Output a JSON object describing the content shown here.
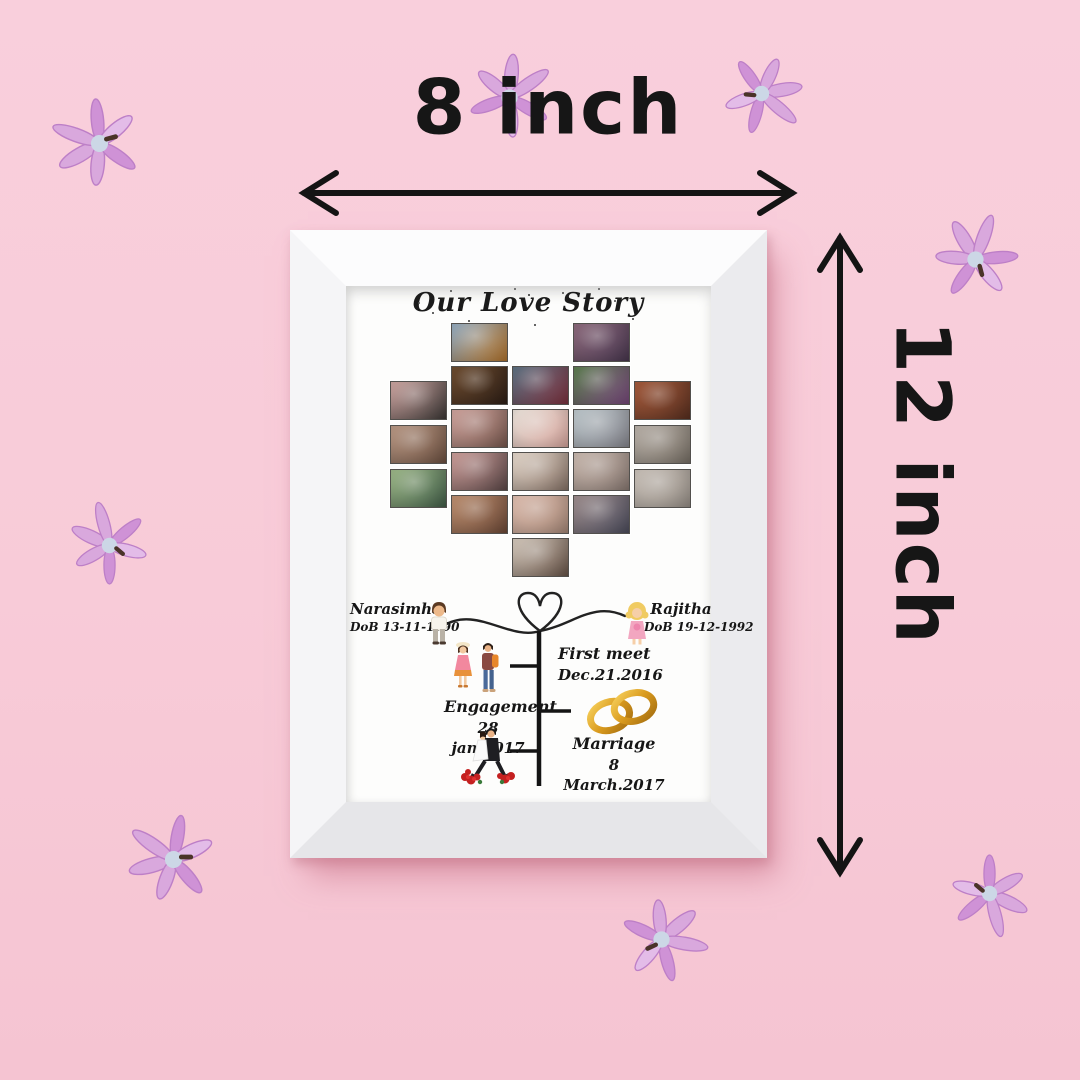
{
  "scene": {
    "description": "Personalized love story photo frame product shot on pink background with lilac hyacinth flowers",
    "background_color": "#f8cbd8",
    "frame_color": "#f5f5f7",
    "annotation_color": "#161616"
  },
  "dimensions": {
    "width_label": "8 inch",
    "height_label": "12 inch"
  },
  "frame": {
    "title": "Our Love Story",
    "timeline": {
      "groom": {
        "name": "Narasimha",
        "dob": "DoB 13-11-1990"
      },
      "bride": {
        "name": "Rajitha",
        "dob": "DoB 19-12-1992"
      },
      "events": [
        {
          "label": "First meet",
          "date": "Dec.21.2016"
        },
        {
          "label": "Engagement",
          "date": "28 jan.2017"
        },
        {
          "label": "Marriage",
          "date": "8 March.2017"
        }
      ],
      "illustrations": {
        "heart": "heart-doodle",
        "groom_avatar": "cartoon-man",
        "bride_avatar": "cartoon-woman",
        "dating_couple": "cartoon-dating-couple",
        "rings": "gold-wedding-rings",
        "wedding_couple": "cartoon-wedding-couple"
      }
    },
    "collage_photos": [
      {
        "col": 0,
        "y": 58,
        "c1": "#c9a29e",
        "c2": "#3f3a38"
      },
      {
        "col": 0,
        "y": 102,
        "c1": "#b59582",
        "c2": "#6e5242"
      },
      {
        "col": 0,
        "y": 146,
        "c1": "#9ab486",
        "c2": "#44604a"
      },
      {
        "col": 1,
        "y": 0,
        "c1": "#8fa7bc",
        "c2": "#b5762e"
      },
      {
        "col": 1,
        "y": 43,
        "c1": "#6b4a2e",
        "c2": "#2e1f16"
      },
      {
        "col": 1,
        "y": 86,
        "c1": "#caa09a",
        "c2": "#7a5a50"
      },
      {
        "col": 1,
        "y": 129,
        "c1": "#c79a96",
        "c2": "#5f4a4a"
      },
      {
        "col": 1,
        "y": 172,
        "c1": "#b98c6e",
        "c2": "#6e4a38"
      },
      {
        "col": 2,
        "y": 43,
        "c1": "#5a6e7e",
        "c2": "#7e3340"
      },
      {
        "col": 2,
        "y": 86,
        "c1": "#e3dbd3",
        "c2": "#d9a8a0"
      },
      {
        "col": 2,
        "y": 129,
        "c1": "#ded2c6",
        "c2": "#8a766a"
      },
      {
        "col": 2,
        "y": 172,
        "c1": "#d9b9ab",
        "c2": "#a98a7a"
      },
      {
        "col": 2,
        "y": 215,
        "c1": "#cfc4b8",
        "c2": "#6a564a"
      },
      {
        "col": 3,
        "y": 0,
        "c1": "#8a687a",
        "c2": "#4a3850"
      },
      {
        "col": 3,
        "y": 43,
        "c1": "#5a7a4e",
        "c2": "#7a4a7e"
      },
      {
        "col": 3,
        "y": 86,
        "c1": "#b8c2c6",
        "c2": "#8a8a92"
      },
      {
        "col": 3,
        "y": 129,
        "c1": "#c4b4aa",
        "c2": "#8d7d76"
      },
      {
        "col": 3,
        "y": 172,
        "c1": "#9a8a8a",
        "c2": "#4e4e5e"
      },
      {
        "col": 4,
        "y": 58,
        "c1": "#a0583a",
        "c2": "#5a3020"
      },
      {
        "col": 4,
        "y": 102,
        "c1": "#b4aca4",
        "c2": "#7a7268"
      },
      {
        "col": 4,
        "y": 146,
        "c1": "#c4bcb4",
        "c2": "#9a928a"
      }
    ]
  },
  "flowers": [
    {
      "x": 52,
      "y": 96,
      "r": -30,
      "s": 1.0
    },
    {
      "x": 462,
      "y": 50,
      "r": 95,
      "s": 0.95
    },
    {
      "x": 714,
      "y": 46,
      "r": 170,
      "s": 0.9
    },
    {
      "x": 928,
      "y": 212,
      "r": 60,
      "s": 0.95
    },
    {
      "x": 62,
      "y": 498,
      "r": 25,
      "s": 0.9
    },
    {
      "x": 126,
      "y": 812,
      "r": -15,
      "s": 1.0
    },
    {
      "x": 614,
      "y": 892,
      "r": 140,
      "s": 0.95
    },
    {
      "x": 942,
      "y": 846,
      "r": 205,
      "s": 0.9
    }
  ]
}
